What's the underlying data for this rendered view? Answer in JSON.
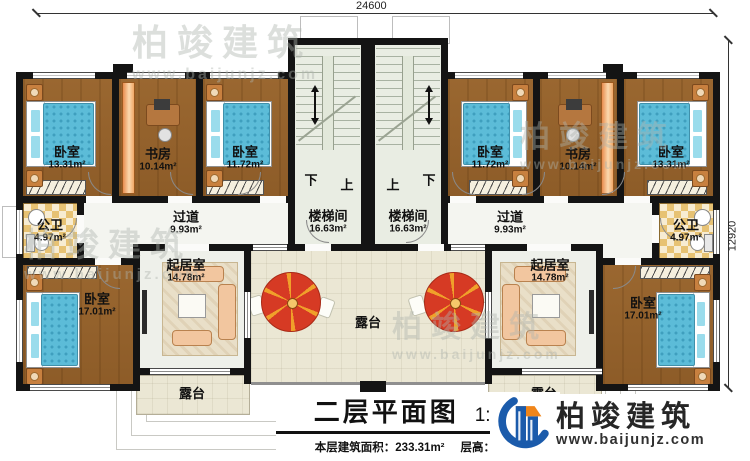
{
  "dimensions": {
    "top": "24600",
    "right": "12920"
  },
  "title_block": {
    "title": "二层平面图",
    "scale": "1:100",
    "area_label": "本层建筑面积：",
    "area_value": "233.31m²",
    "height_label": "层高：",
    "height_value": "3.9m"
  },
  "brand": {
    "name": "柏竣建筑",
    "website": "www.baijunjz.com"
  },
  "watermark": {
    "name": "柏竣建筑",
    "website": "www.baijunjz.com"
  },
  "stair_labels": [
    {
      "text": "下"
    },
    {
      "text": "上"
    },
    {
      "text": "上"
    },
    {
      "text": "下"
    }
  ],
  "terraces": [
    {
      "name": "露台"
    },
    {
      "name": "露台"
    },
    {
      "name": "露台"
    }
  ],
  "rooms": [
    {
      "name": "卧室",
      "area": "13.31m²"
    },
    {
      "name": "书房",
      "area": "10.14m²"
    },
    {
      "name": "卧室",
      "area": "11.72m²"
    },
    {
      "name": "楼梯间",
      "area": "16.63m²"
    },
    {
      "name": "楼梯间",
      "area": "16.63m²"
    },
    {
      "name": "卧室",
      "area": "11.72m²"
    },
    {
      "name": "书房",
      "area": "10.14m²"
    },
    {
      "name": "卧室",
      "area": "13.31m²"
    },
    {
      "name": "公卫",
      "area": "4.97m²"
    },
    {
      "name": "过道",
      "area": "9.93m²"
    },
    {
      "name": "过道",
      "area": "9.93m²"
    },
    {
      "name": "公卫",
      "area": "4.97m²"
    },
    {
      "name": "卧室",
      "area": "17.01m²"
    },
    {
      "name": "起居室",
      "area": "14.78m²"
    },
    {
      "name": "起居室",
      "area": "14.78m²"
    },
    {
      "name": "卧室",
      "area": "17.01m²"
    }
  ],
  "colors": {
    "wall": "#141414",
    "wood_floor": "#96632e",
    "bed_blue": "#5cbcd8",
    "terrace_beige": "#ebe7d4",
    "bath_tile": "#e7c273",
    "umbrella_red": "#d63a24",
    "brand_blue": "#1b5bab",
    "brand_orange": "#f08519"
  }
}
